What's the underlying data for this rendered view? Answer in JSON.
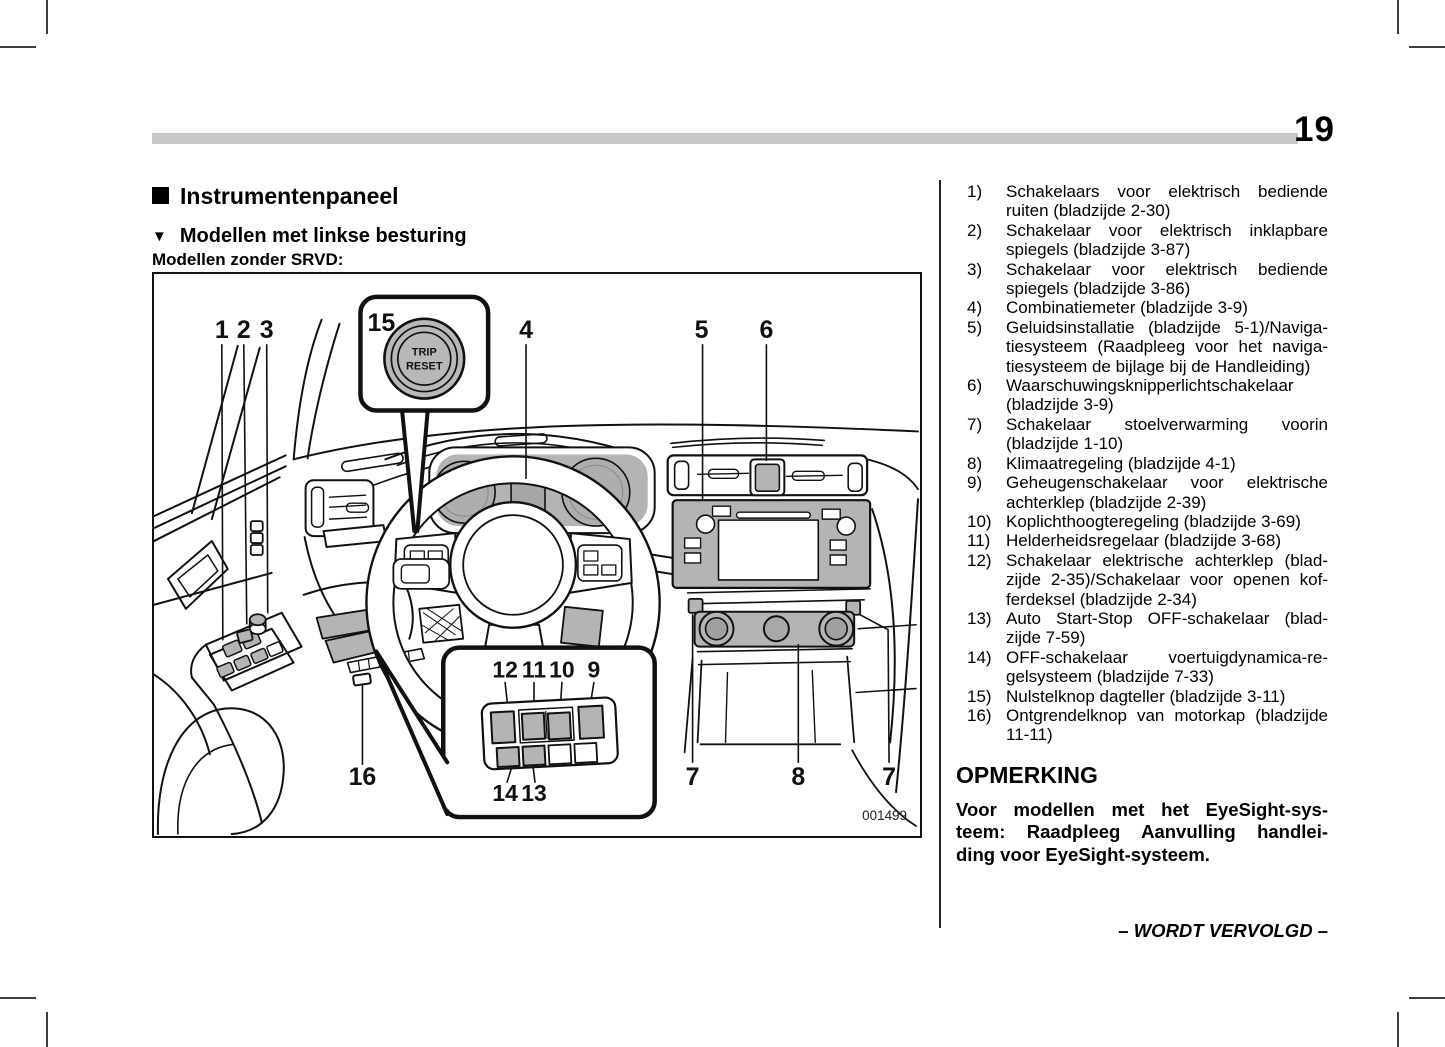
{
  "page": {
    "number": "19"
  },
  "header": {
    "section_title": "Instrumentenpaneel",
    "subsection_title": "Modellen met linkse besturing",
    "variant_label": "Modellen zonder SRVD:"
  },
  "figure": {
    "code": "001499",
    "trip_reset_button": {
      "line1": "TRIP",
      "line2": "RESET"
    },
    "callouts": {
      "c1": "1",
      "c2": "2",
      "c3": "3",
      "c4": "4",
      "c5": "5",
      "c6": "6",
      "c7_left": "7",
      "c8": "8",
      "c7_right": "7",
      "c15": "15",
      "c16": "16",
      "c12": "12",
      "c11": "11",
      "c10": "10",
      "c9": "9",
      "c14": "14",
      "c13": "13"
    }
  },
  "legend": {
    "items": [
      {
        "num": "1)",
        "lines": [
          "Schakelaars voor elektrisch bediende",
          "ruiten (bladzijde 2-30)"
        ]
      },
      {
        "num": "2)",
        "lines": [
          "Schakelaar voor elektrisch inklapbare",
          "spiegels (bladzijde 3-87)"
        ]
      },
      {
        "num": "3)",
        "lines": [
          "Schakelaar voor elektrisch bediende",
          "spiegels (bladzijde 3-86)"
        ]
      },
      {
        "num": "4)",
        "lines": [
          "Combinatiemeter (bladzijde 3-9)"
        ]
      },
      {
        "num": "5)",
        "lines": [
          "Geluidsinstallatie (bladzijde 5-1)/Naviga-",
          "tiesysteem (Raadpleeg voor het naviga-",
          "tiesysteem de bijlage bij de Handleiding)"
        ]
      },
      {
        "num": "6)",
        "lines": [
          "Waarschuwingsknipperlichtschakelaar",
          "(bladzijde 3-9)"
        ]
      },
      {
        "num": "7)",
        "lines": [
          "Schakelaar stoelverwarming voorin",
          "(bladzijde 1-10)"
        ]
      },
      {
        "num": "8)",
        "lines": [
          "Klimaatregeling (bladzijde 4-1)"
        ]
      },
      {
        "num": "9)",
        "lines": [
          "Geheugenschakelaar voor elektrische",
          "achterklep (bladzijde 2-39)"
        ]
      },
      {
        "num": "10)",
        "lines": [
          "Koplichthoogteregeling (bladzijde 3-69)"
        ]
      },
      {
        "num": "11)",
        "lines": [
          "Helderheidsregelaar (bladzijde 3-68)"
        ]
      },
      {
        "num": "12)",
        "lines": [
          "Schakelaar elektrische achterklep (blad-",
          "zijde 2-35)/Schakelaar voor openen kof-",
          "ferdeksel (bladzijde 2-34)"
        ]
      },
      {
        "num": "13)",
        "lines": [
          "Auto Start-Stop OFF-schakelaar (blad-",
          "zijde 7-59)"
        ]
      },
      {
        "num": "14)",
        "lines": [
          "OFF-schakelaar voertuigdynamica-re-",
          "gelsysteem (bladzijde 7-33)"
        ]
      },
      {
        "num": "15)",
        "lines": [
          "Nulstelknop dagteller (bladzijde 3-11)"
        ]
      },
      {
        "num": "16)",
        "lines": [
          "Ontgrendelknop van motorkap (bladzijde",
          "11-11)"
        ]
      }
    ]
  },
  "note": {
    "title": "OPMERKING",
    "body_lines": [
      "Voor modellen met het EyeSight-sys-",
      "teem: Raadpleeg Aanvulling handlei-",
      "ding voor EyeSight-systeem."
    ]
  },
  "footer": {
    "continuation": "– WORDT VERVOLGD –"
  }
}
